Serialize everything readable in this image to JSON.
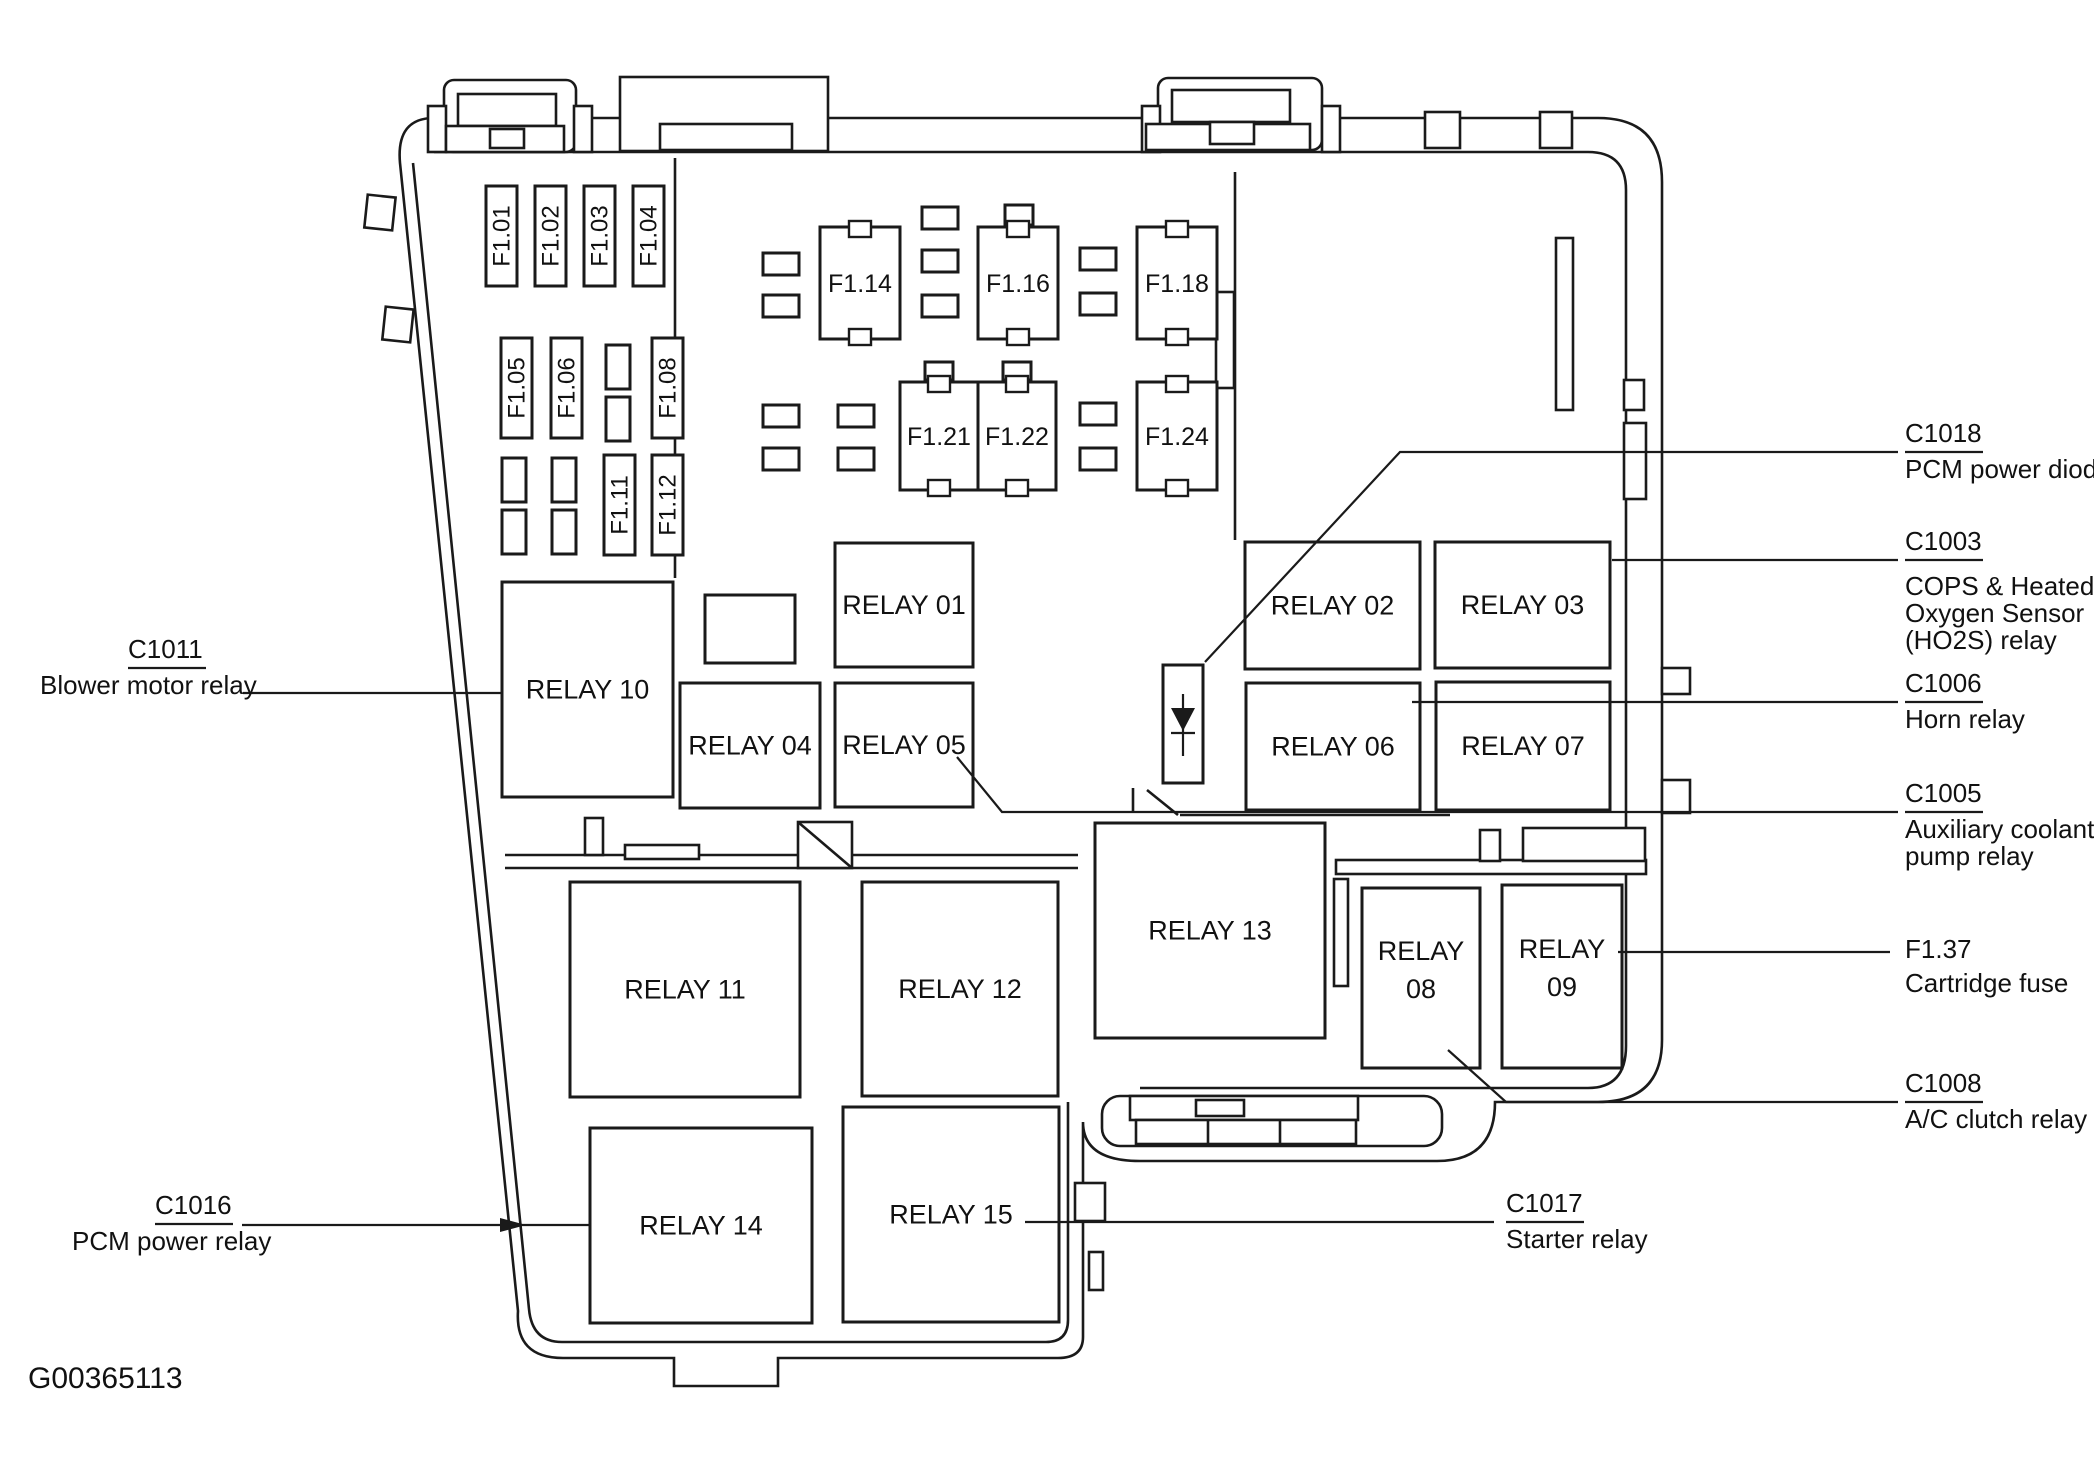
{
  "figure_id": "G00365113",
  "colors": {
    "ink": "#1a1a1a",
    "background": "#ffffff"
  },
  "diagram": {
    "type": "fuse-relay-box",
    "vertical_fuses": [
      {
        "label": "F1.01",
        "x": 486,
        "y": 186,
        "w": 31,
        "h": 100
      },
      {
        "label": "F1.02",
        "x": 535,
        "y": 186,
        "w": 31,
        "h": 100
      },
      {
        "label": "F1.03",
        "x": 584,
        "y": 186,
        "w": 31,
        "h": 100
      },
      {
        "label": "F1.04",
        "x": 633,
        "y": 186,
        "w": 31,
        "h": 100
      },
      {
        "label": "F1.05",
        "x": 501,
        "y": 338,
        "w": 31,
        "h": 100
      },
      {
        "label": "F1.06",
        "x": 551,
        "y": 338,
        "w": 31,
        "h": 100
      },
      {
        "label": "F1.08",
        "x": 652,
        "y": 338,
        "w": 31,
        "h": 100
      },
      {
        "label": "F1.11",
        "x": 604,
        "y": 455,
        "w": 31,
        "h": 100
      },
      {
        "label": "F1.12",
        "x": 652,
        "y": 455,
        "w": 31,
        "h": 100
      }
    ],
    "small_fuses_vertical": [
      [
        606,
        345
      ],
      [
        606,
        397
      ],
      [
        502,
        458
      ],
      [
        502,
        510
      ],
      [
        552,
        458
      ],
      [
        552,
        510
      ]
    ],
    "small_fuses_horizontal": [
      [
        763,
        253
      ],
      [
        763,
        295
      ],
      [
        922,
        207
      ],
      [
        922,
        250
      ],
      [
        922,
        295
      ],
      [
        1080,
        248
      ],
      [
        1080,
        293
      ],
      [
        763,
        405
      ],
      [
        763,
        448
      ],
      [
        838,
        405
      ],
      [
        838,
        448
      ],
      [
        1080,
        403
      ],
      [
        1080,
        448
      ]
    ],
    "small_tabs": [
      [
        925,
        362,
        28,
        18
      ],
      [
        1003,
        362,
        28,
        18
      ],
      [
        1005,
        205,
        28,
        20
      ]
    ],
    "square_fuses": [
      {
        "label": "F1.14",
        "x": 820,
        "y": 227,
        "w": 80,
        "h": 112
      },
      {
        "label": "F1.16",
        "x": 978,
        "y": 227,
        "w": 80,
        "h": 112
      },
      {
        "label": "F1.18",
        "x": 1137,
        "y": 227,
        "w": 80,
        "h": 112
      },
      {
        "label": "F1.21",
        "x": 900,
        "y": 382,
        "w": 78,
        "h": 108
      },
      {
        "label": "F1.22",
        "x": 978,
        "y": 382,
        "w": 78,
        "h": 108
      },
      {
        "label": "F1.24",
        "x": 1137,
        "y": 382,
        "w": 80,
        "h": 108
      }
    ],
    "plain_boxes": [
      [
        705,
        595,
        90,
        68
      ]
    ],
    "relays": [
      {
        "label": "RELAY 10",
        "x": 502,
        "y": 582,
        "w": 171,
        "h": 215
      },
      {
        "label": "RELAY 01",
        "x": 835,
        "y": 543,
        "w": 138,
        "h": 124
      },
      {
        "label": "RELAY 04",
        "x": 680,
        "y": 683,
        "w": 140,
        "h": 125
      },
      {
        "label": "RELAY 05",
        "x": 835,
        "y": 683,
        "w": 138,
        "h": 124
      },
      {
        "label": "RELAY 02",
        "x": 1245,
        "y": 542,
        "w": 175,
        "h": 127
      },
      {
        "label": "RELAY 03",
        "x": 1435,
        "y": 542,
        "w": 175,
        "h": 126
      },
      {
        "label": "RELAY 06",
        "x": 1246,
        "y": 683,
        "w": 174,
        "h": 127
      },
      {
        "label": "RELAY 07",
        "x": 1436,
        "y": 682,
        "w": 174,
        "h": 128
      },
      {
        "label": "RELAY 13",
        "x": 1095,
        "y": 823,
        "w": 230,
        "h": 215
      },
      {
        "label": "RELAY 11",
        "x": 570,
        "y": 882,
        "w": 230,
        "h": 215
      },
      {
        "label": "RELAY 12",
        "x": 862,
        "y": 882,
        "w": 196,
        "h": 214
      },
      {
        "label": "RELAY 14",
        "x": 590,
        "y": 1128,
        "w": 222,
        "h": 195
      },
      {
        "label": "RELAY 15",
        "x": 843,
        "y": 1107,
        "w": 216,
        "h": 215
      },
      {
        "label": "RELAY 08",
        "lines": [
          "RELAY",
          "08"
        ],
        "x": 1362,
        "y": 888,
        "w": 118,
        "h": 180
      },
      {
        "label": "RELAY 09",
        "lines": [
          "RELAY",
          "09"
        ],
        "x": 1502,
        "y": 885,
        "w": 120,
        "h": 183
      }
    ],
    "diode": {
      "name": "PCM power diode",
      "box": [
        1163,
        665,
        40,
        118
      ]
    },
    "callouts": [
      {
        "title": "C1018",
        "underline": true,
        "tx": 1905,
        "tb": 442,
        "uy": 452,
        "dx": 1905,
        "desc": [
          "PCM power diode"
        ],
        "db": [
          478
        ],
        "leader": [
          [
            1205,
            662
          ],
          [
            1400,
            452
          ],
          [
            1898,
            452
          ]
        ]
      },
      {
        "title": "C1003",
        "underline": true,
        "tx": 1905,
        "tb": 550,
        "uy": 560,
        "dx": 1905,
        "desc": [
          "COPS & Heated",
          "Oxygen Sensor",
          "(HO2S) relay"
        ],
        "db": [
          595,
          622,
          649
        ],
        "leader": [
          [
            1612,
            560
          ],
          [
            1898,
            560
          ]
        ]
      },
      {
        "title": "C1006",
        "underline": true,
        "tx": 1905,
        "tb": 692,
        "uy": 702,
        "dx": 1905,
        "desc": [
          "Horn relay"
        ],
        "db": [
          728
        ],
        "leader": [
          [
            1412,
            702
          ],
          [
            1898,
            702
          ]
        ]
      },
      {
        "title": "C1005",
        "underline": true,
        "tx": 1905,
        "tb": 802,
        "uy": 812,
        "dx": 1905,
        "desc": [
          "Auxiliary coolant",
          "pump relay"
        ],
        "db": [
          838,
          865
        ],
        "leader": [
          [
            957,
            757
          ],
          [
            1002,
            812
          ],
          [
            1898,
            812
          ]
        ]
      },
      {
        "title": "F1.37",
        "underline": false,
        "tx": 1905,
        "tb": 958,
        "dx": 1905,
        "desc": [
          "Cartridge fuse"
        ],
        "db": [
          992
        ],
        "leader": [
          [
            1618,
            952
          ],
          [
            1890,
            952
          ]
        ]
      },
      {
        "title": "C1008",
        "underline": true,
        "tx": 1905,
        "tb": 1092,
        "uy": 1102,
        "dx": 1905,
        "desc": [
          "A/C clutch relay"
        ],
        "db": [
          1128
        ],
        "leader": [
          [
            1448,
            1050
          ],
          [
            1506,
            1102
          ],
          [
            1898,
            1102
          ]
        ]
      },
      {
        "title": "C1011",
        "underline": true,
        "tx": 128,
        "tb": 658,
        "uy": 668,
        "dx": 40,
        "desc": [
          "Blower motor relay"
        ],
        "db": [
          694
        ],
        "leader": [
          [
            243,
            693
          ],
          [
            502,
            693
          ]
        ]
      },
      {
        "title": "C1016",
        "underline": true,
        "tx": 155,
        "tb": 1214,
        "uy": 1224,
        "dx": 72,
        "desc": [
          "PCM power relay"
        ],
        "db": [
          1250
        ],
        "leader": [
          [
            242,
            1225
          ],
          [
            590,
            1225
          ]
        ],
        "arrow": "500,1218 500,1232 526,1225"
      },
      {
        "title": "C1017",
        "underline": true,
        "tx": 1506,
        "tb": 1212,
        "uy": 1222,
        "dx": 1506,
        "desc": [
          "Starter relay"
        ],
        "db": [
          1248
        ],
        "leader": [
          [
            1025,
            1222
          ],
          [
            1494,
            1222
          ]
        ]
      }
    ]
  }
}
